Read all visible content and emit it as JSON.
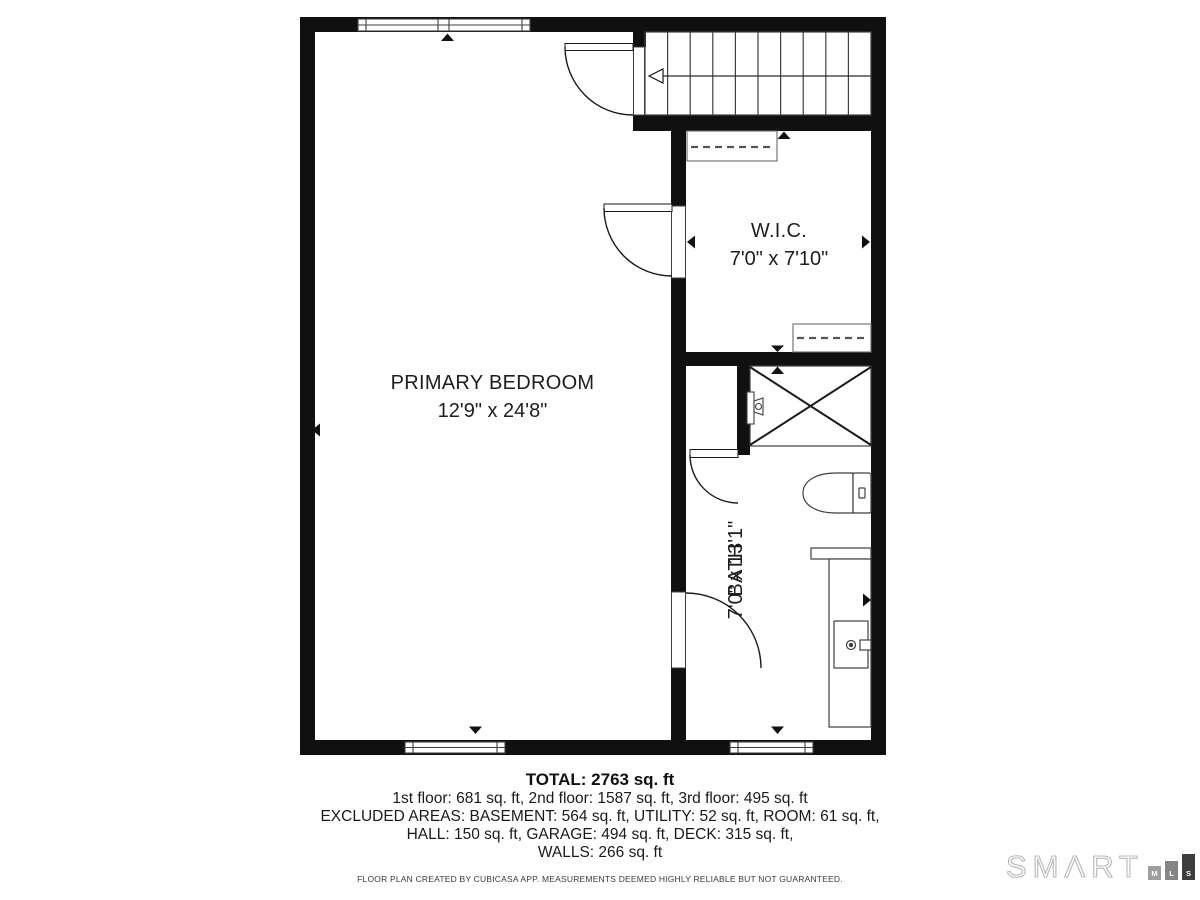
{
  "plan": {
    "rooms": {
      "primary_bedroom": {
        "name": "PRIMARY BEDROOM",
        "dimensions": "12'9\" x 24'8\""
      },
      "wic": {
        "name": "W.I.C.",
        "dimensions": "7'0\" x 7'10\""
      },
      "bath": {
        "name": "BATH",
        "dimensions": "7'0\" x 13'1\""
      }
    }
  },
  "summary": {
    "total": "TOTAL: 2763 sq. ft",
    "floors": "1st floor: 681 sq. ft, 2nd floor: 1587 sq. ft, 3rd floor: 495 sq. ft",
    "excluded_line1": "EXCLUDED AREAS: BASEMENT: 564 sq. ft, UTILITY: 52 sq. ft, ROOM: 61 sq. ft,",
    "excluded_line2": "HALL: 150 sq. ft, GARAGE: 494 sq. ft, DECK: 315 sq. ft,",
    "excluded_line3": "WALLS: 266 sq. ft"
  },
  "disclaimer": "FLOOR PLAN CREATED BY CUBICASA APP. MEASUREMENTS DEEMED HIGHLY RELIABLE BUT NOT GUARANTEED.",
  "logo": {
    "brand": "SMΛRT",
    "blocks": [
      "M",
      "L",
      "S"
    ]
  },
  "colors": {
    "wall": "#101010",
    "fixture_line": "#3f3f3f",
    "door_line": "#1a1a1a",
    "text": "#1d1d1d",
    "logo_block_m": "#9e9e9e",
    "logo_block_l": "#858585",
    "logo_block_s": "#3d3d3d"
  }
}
